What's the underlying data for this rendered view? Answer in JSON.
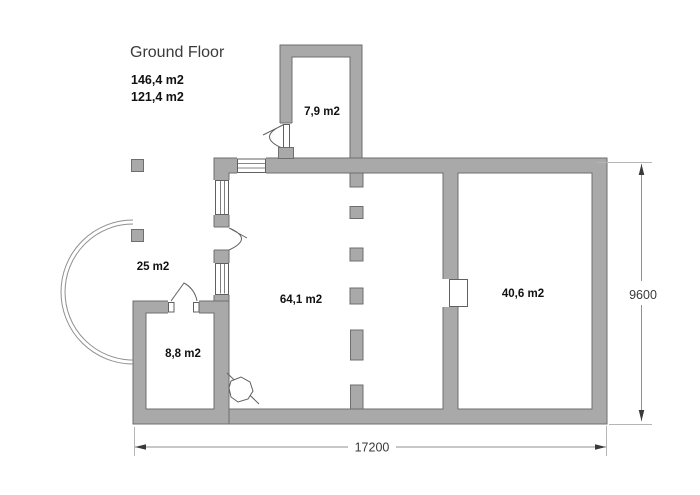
{
  "title": "Ground Floor",
  "summary": {
    "gross_area": "146,4 m2",
    "net_area": "121,4 m2"
  },
  "rooms": {
    "annex": "7,9 m2",
    "terrace": "25 m2",
    "main_room": "64,1 m2",
    "right_room": "40,6 m2",
    "small_room": "8,8 m2"
  },
  "dimensions": {
    "total_width": "17200",
    "total_height": "9600"
  },
  "colors": {
    "wall_fill": "#a9a9a9",
    "wall_stroke": "#6e6e6e",
    "line": "#606060",
    "dim_line": "#8f8f8f",
    "ext_line": "#b5b5b5",
    "text": "#111111",
    "dim_text": "#3a3a3a"
  }
}
